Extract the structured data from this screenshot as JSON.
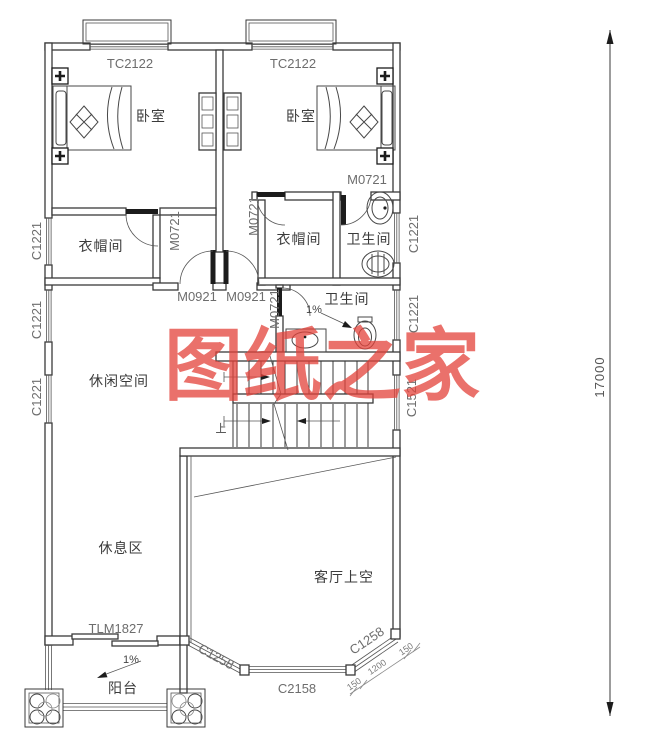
{
  "plan": {
    "title_watermark": "图纸之家",
    "overall_dim": "17000",
    "rooms": {
      "bedroom_left": "卧室",
      "bedroom_right": "卧室",
      "cloakroom_left": "衣帽间",
      "cloakroom_right": "衣帽间",
      "bathroom_top": "卫生间",
      "bathroom_mid": "卫生间",
      "leisure_space": "休闲空间",
      "rest_area": "休息区",
      "living_void": "客厅上空",
      "balcony": "阳台"
    },
    "windows": {
      "tc2122_left": "TC2122",
      "tc2122_right": "TC2122",
      "c1221_left_1": "C1221",
      "c1221_left_2": "C1221",
      "c1221_left_3": "C1221",
      "c1221_right_1": "C1221",
      "c1221_right_2": "C1221",
      "c1521_right": "C1521",
      "c1258_left": "C1258",
      "c1258_right": "C1258",
      "c2158_bottom": "C2158"
    },
    "doors": {
      "m0721_bath_top": "M0721",
      "m0721_cloak_left": "M0721",
      "m0721_cloak_right": "M0721",
      "m0721_bath_mid": "M0721",
      "m0921_left": "M0921",
      "m0921_right": "M0921",
      "tlm1827_balcony": "TLM1827"
    },
    "annotations": {
      "stairs_up": "上",
      "slope_bath": "1%",
      "slope_balcony": "1%",
      "dim_150_a": "150",
      "dim_1200": "1200",
      "dim_150_b": "150"
    },
    "colors": {
      "line": "#3a3a3a",
      "code_text": "#6d6d6d",
      "watermark": "#e4423a"
    }
  }
}
